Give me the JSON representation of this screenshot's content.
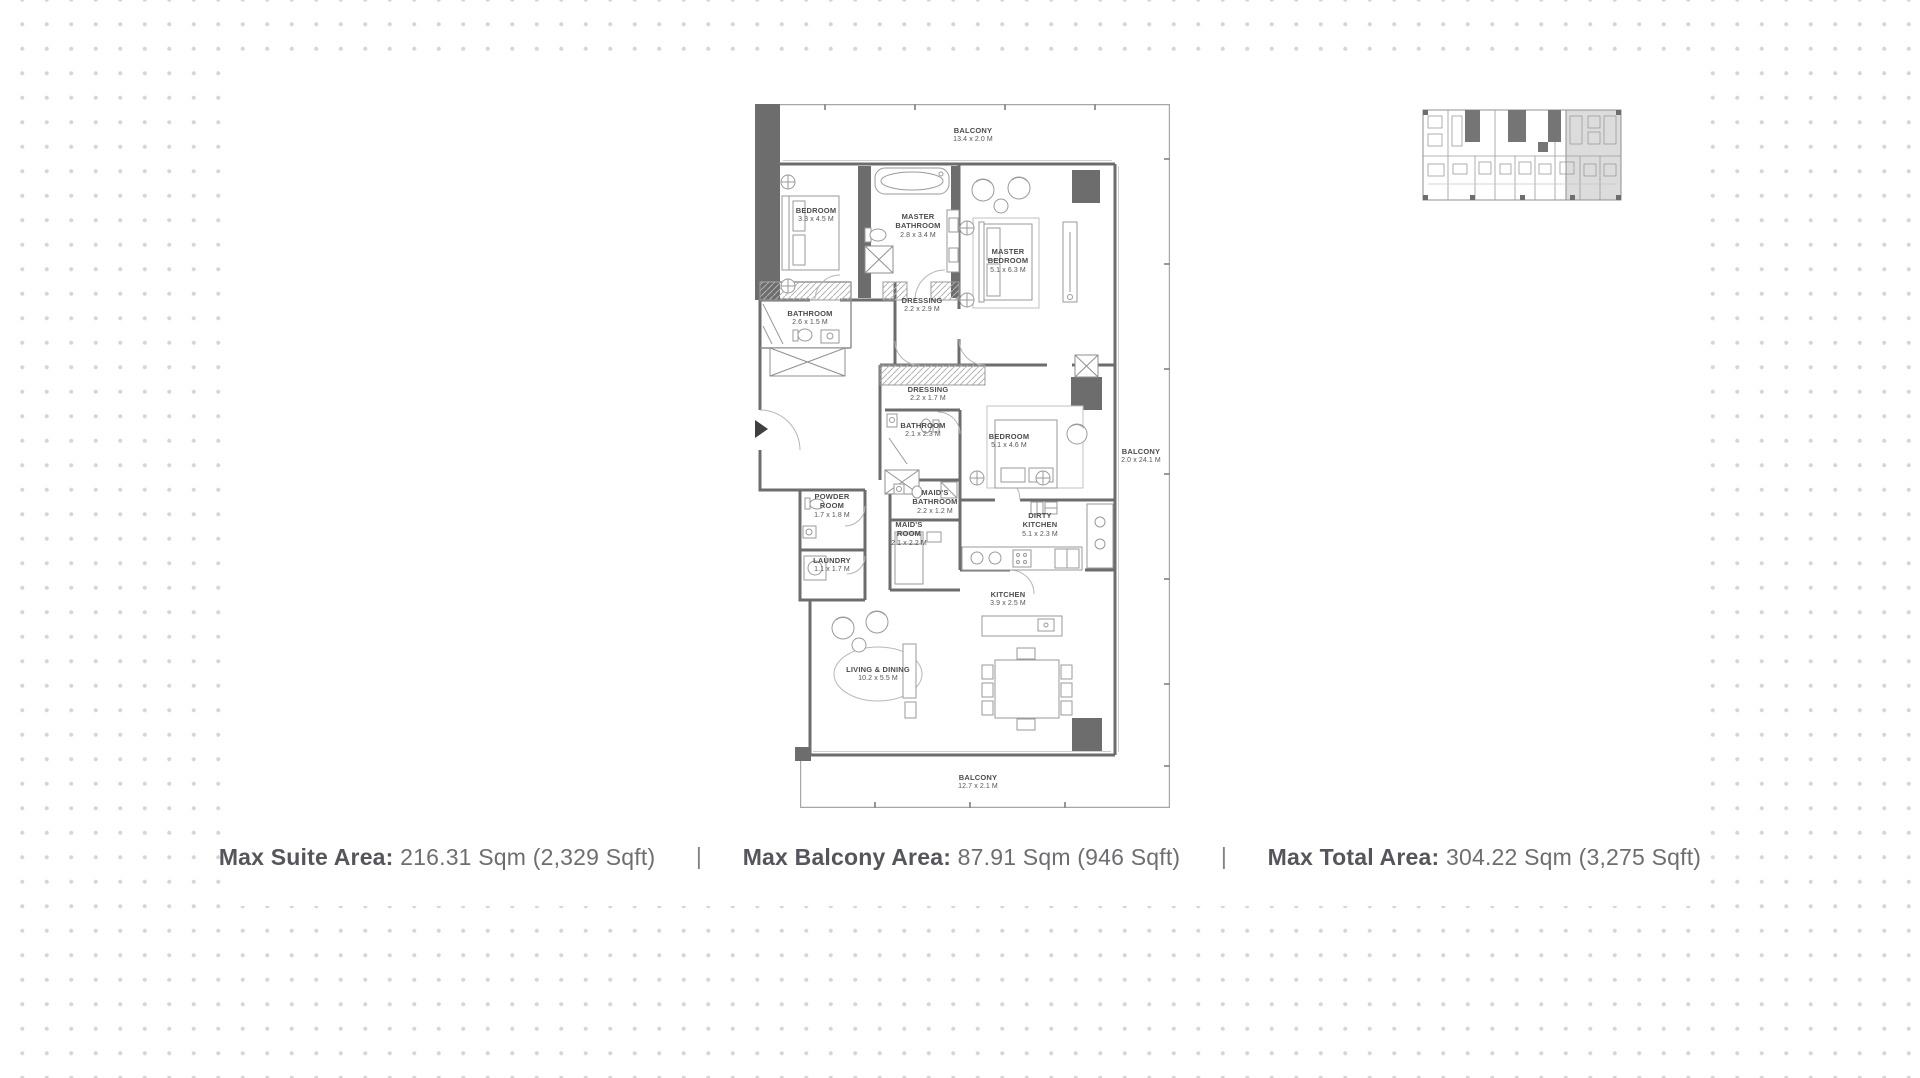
{
  "colors": {
    "wall": "#6d6d6d",
    "line_mid": "#9b9b9b",
    "line_light": "#c7c7c7",
    "background_dot": "#d6d6d6",
    "summary_label_text": "#55565b",
    "summary_value_text": "#6d6e71",
    "room_label_text": "#4c4c4c",
    "key_plan_highlight": "#dcdcdc"
  },
  "floor_plan": {
    "rooms": [
      {
        "name": "BALCONY",
        "dims": "13.4 x 2.0 M"
      },
      {
        "name": "BEDROOM",
        "dims": "3.3 x 4.5 M"
      },
      {
        "name": "MASTER BATHROOM",
        "dims": "2.8 x 3.4 M"
      },
      {
        "name": "MASTER BEDROOM",
        "dims": "5.1 x 6.3 M"
      },
      {
        "name": "DRESSING",
        "dims": "2.2 x 2.9 M"
      },
      {
        "name": "BATHROOM",
        "dims": "2.6 x 1.5 M"
      },
      {
        "name": "DRESSING",
        "dims": "2.2 x 1.7 M"
      },
      {
        "name": "BATHROOM",
        "dims": "2.1 x 2.3 M"
      },
      {
        "name": "BEDROOM",
        "dims": "5.1 x 4.6 M"
      },
      {
        "name": "BALCONY",
        "dims": "2.0 x 24.1 M"
      },
      {
        "name": "MAID'S BATHROOM",
        "dims": "2.2 x 1.2 M"
      },
      {
        "name": "POWDER ROOM",
        "dims": "1.7 x 1.8 M"
      },
      {
        "name": "MAID'S ROOM",
        "dims": "2.1 x 2.2 M"
      },
      {
        "name": "DIRTY KITCHEN",
        "dims": "5.1 x 2.3 M"
      },
      {
        "name": "LAUNDRY",
        "dims": "1.1 x 1.7 M"
      },
      {
        "name": "KITCHEN",
        "dims": "3.9 x 2.5 M"
      },
      {
        "name": "LIVING & DINING",
        "dims": "10.2 x 5.5 M"
      },
      {
        "name": "BALCONY",
        "dims": "12.7 x 2.1 M"
      }
    ]
  },
  "summary": {
    "separator": "|",
    "items": [
      {
        "label": "Max Suite Area:",
        "value": "216.31 Sqm (2,329 Sqft)"
      },
      {
        "label": "Max Balcony Area:",
        "value": "87.91 Sqm (946 Sqft)"
      },
      {
        "label": "Max Total Area:",
        "value": "304.22 Sqm (3,275 Sqft)"
      }
    ]
  }
}
